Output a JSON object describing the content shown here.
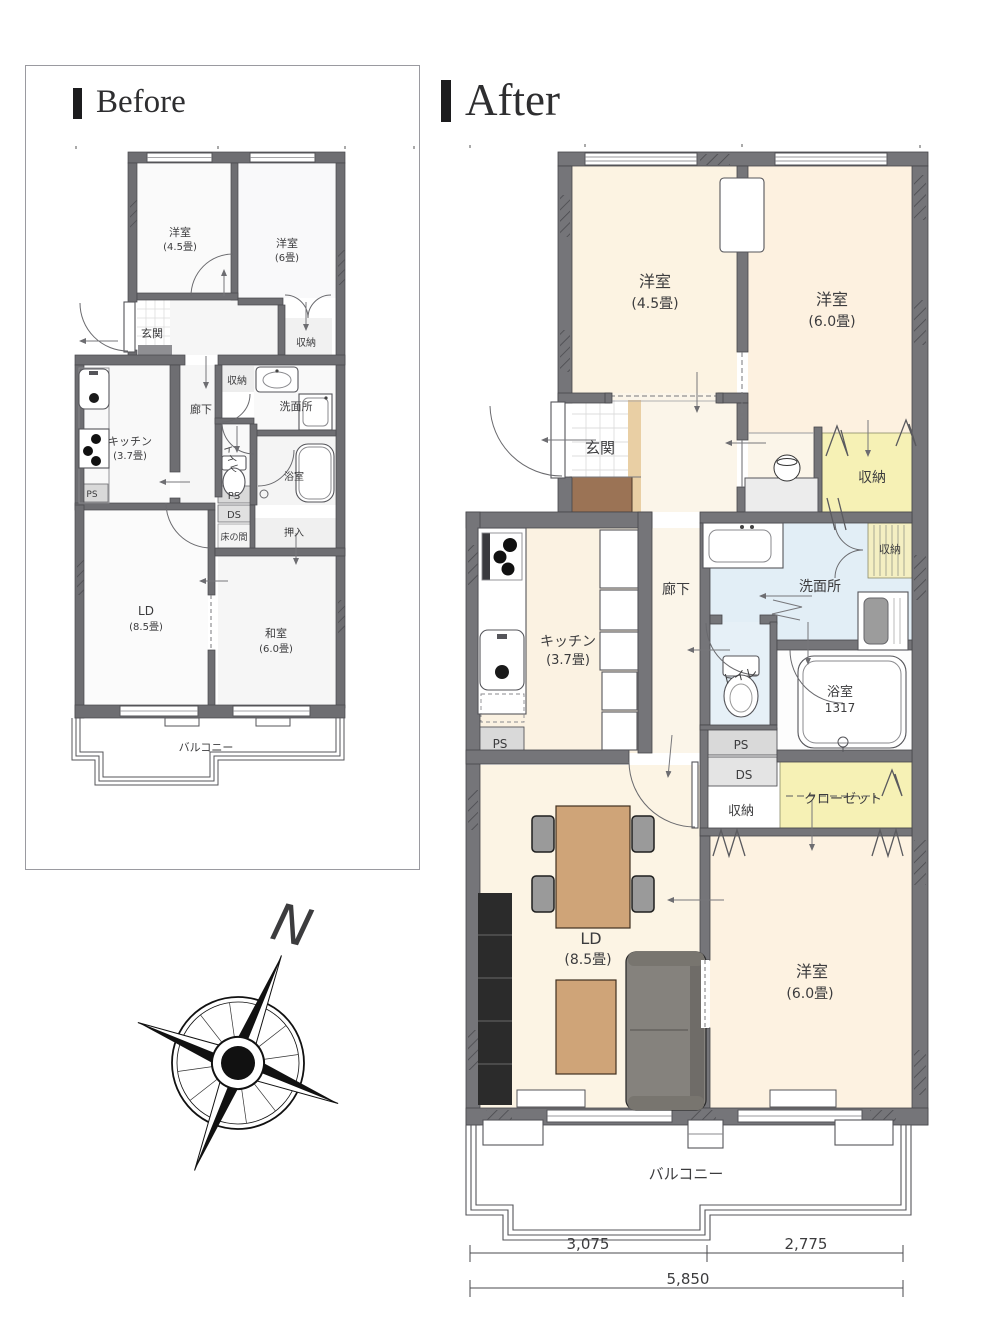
{
  "page": {
    "background": "#ffffff"
  },
  "colors": {
    "wall_after": "#757579",
    "wall_before": "#6e6e72",
    "room_cream": "#fcf3e2",
    "hall_cream": "#fbf5e9",
    "storage_yellow": "#f6f1b5",
    "wet_blue": "#e2eef6",
    "wood_strip": "#e9cfa4",
    "shoe_cabinet": "#9b7355",
    "table_wood": "#cfa478",
    "sofa_gray": "#85827d",
    "tv_board_black": "#2b2b2b"
  },
  "before": {
    "title": "Before",
    "labels": {
      "room45_name": "洋室",
      "room45_size": "(4.5畳)",
      "room6_name": "洋室",
      "room6_size": "(6畳)",
      "genkan": "玄関",
      "shuno_right": "収納",
      "shuno_mid": "収納",
      "senmenjo": "洗面所",
      "kitchen_name": "キッチン",
      "kitchen_size": "(3.7畳)",
      "roka": "廊下",
      "toilet": "トイレ",
      "bath": "浴室",
      "ps_left": "PS",
      "ps_right": "PS",
      "ds": "DS",
      "tokonoma": "床の間",
      "oshiire": "押入",
      "ld_name": "LD",
      "ld_size": "(8.5畳)",
      "washitsu_name": "和室",
      "washitsu_size": "(6.0畳)",
      "balcony": "バルコニー"
    }
  },
  "after": {
    "title": "After",
    "labels": {
      "room45_name": "洋室",
      "room45_size": "(4.5畳)",
      "room60_top_name": "洋室",
      "room60_top_size": "(6.0畳)",
      "genkan": "玄関",
      "shuno_top_right": "収納",
      "roka": "廊下",
      "senmenjo": "洗面所",
      "shuno_side": "収納",
      "kitchen_name": "キッチン",
      "kitchen_size": "(3.7畳)",
      "toilet": "トイレ",
      "bath_name": "浴室",
      "bath_size": "1317",
      "ps_left": "PS",
      "ps_right": "PS",
      "ds": "DS",
      "shuno_mid": "収納",
      "closet": "クローゼット",
      "ld_name": "LD",
      "ld_size": "(8.5畳)",
      "room60_bottom_name": "洋室",
      "room60_bottom_size": "(6.0畳)",
      "balcony": "バルコニー"
    },
    "dimensions": {
      "seg_left": "3,075",
      "seg_right": "2,775",
      "total": "5,850"
    }
  },
  "compass": {
    "north": "N"
  }
}
